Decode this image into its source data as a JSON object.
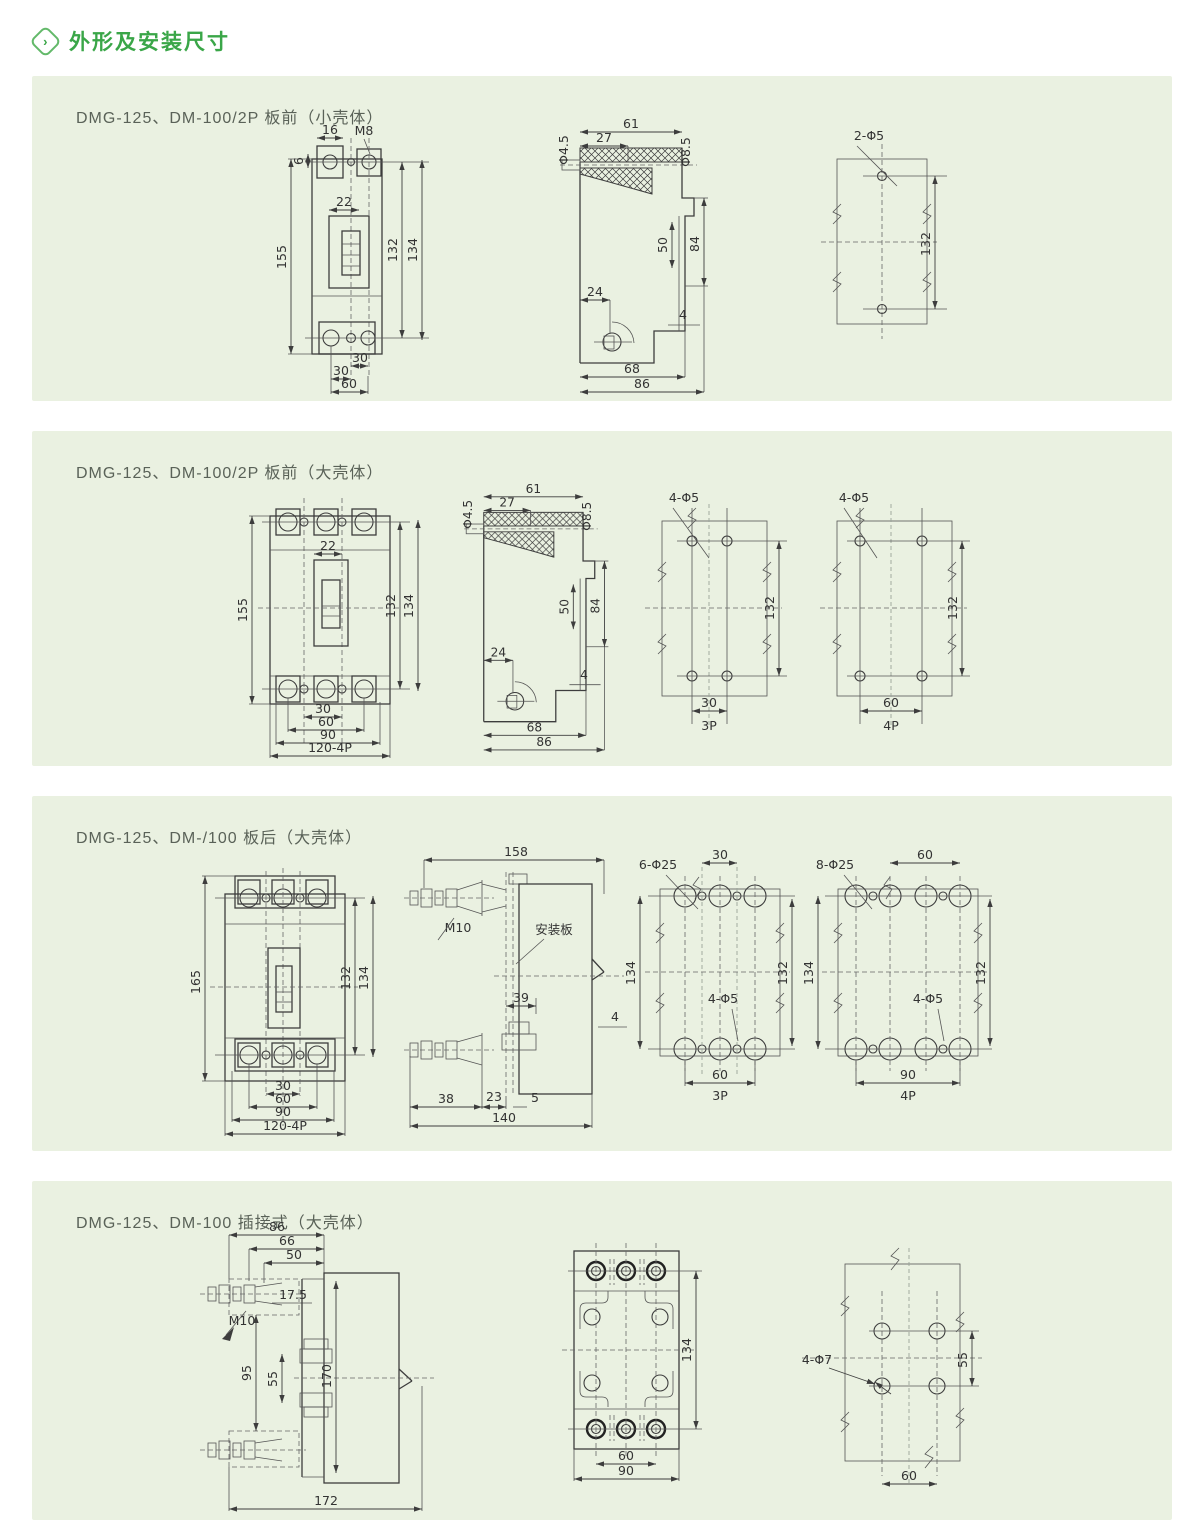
{
  "header": {
    "icon": "chevron-right-icon",
    "title": "外形及安装尺寸"
  },
  "colors": {
    "accent_green": "#3aa648",
    "panel_bg": "#eaf1e1",
    "line": "#3d3d3d"
  },
  "panels": [
    {
      "title": "DMG-125、DM-100/2P 板前（小壳体）",
      "front": {
        "d16": "16",
        "m8": "M8",
        "d6": "6",
        "d22": "22",
        "d155": "155",
        "d132": "132",
        "d134": "134",
        "d30a": "30",
        "d30b": "30",
        "d60": "60"
      },
      "side": {
        "d61": "61",
        "d27": "27",
        "phi45": "Φ4.5",
        "phi85": "Φ8.5",
        "d50": "50",
        "d84": "84",
        "d24": "24",
        "d4": "4",
        "d68": "68",
        "d86": "86"
      },
      "holes": {
        "label": "2-Φ5",
        "d132": "132"
      }
    },
    {
      "title": "DMG-125、DM-100/2P 板前（大壳体）",
      "front": {
        "d22": "22",
        "d155": "155",
        "d132": "132",
        "d134": "134",
        "d30": "30",
        "d60": "60",
        "d90": "90",
        "d120": "120-4P"
      },
      "side": {
        "d61": "61",
        "d27": "27",
        "phi45": "Φ4.5",
        "phi85": "Φ8.5",
        "d50": "50",
        "d84": "84",
        "d24": "24",
        "d4": "4",
        "d68": "68",
        "d86": "86"
      },
      "holes3p": {
        "label": "4-Φ5",
        "d132": "132",
        "d30": "30",
        "pole": "3P"
      },
      "holes4p": {
        "label": "4-Φ5",
        "d132": "132",
        "d60": "60",
        "pole": "4P"
      }
    },
    {
      "title": "DMG-125、DM-/100 板后（大壳体）",
      "front": {
        "d165": "165",
        "d132": "132",
        "d134": "134",
        "d30": "30",
        "d60": "60",
        "d90": "90",
        "d120": "120-4P"
      },
      "side": {
        "d158": "158",
        "m10": "M10",
        "plate": "安装板",
        "d39": "39",
        "d4": "4",
        "d38": "38",
        "d23": "23",
        "d5": "5",
        "d140": "140"
      },
      "holes3p": {
        "label": "6-Φ25",
        "d30": "30",
        "d134": "134",
        "d132": "132",
        "small": "4-Φ5",
        "d60": "60",
        "pole": "3P"
      },
      "holes4p": {
        "label": "8-Φ25",
        "d60": "60",
        "d134": "134",
        "d132": "132",
        "small": "4-Φ5",
        "d90": "90",
        "pole": "4P"
      }
    },
    {
      "title": "DMG-125、DM-100 插接式（大壳体）",
      "side": {
        "d86": "86",
        "d66": "66",
        "d50": "50",
        "d175": "17.5",
        "m10": "M10",
        "d95": "95",
        "d55": "55",
        "d170": "170",
        "d172": "172"
      },
      "base": {
        "d134": "134",
        "d60": "60",
        "d90": "90"
      },
      "holes": {
        "label": "4-Φ7",
        "d55": "55",
        "d60": "60"
      }
    }
  ]
}
